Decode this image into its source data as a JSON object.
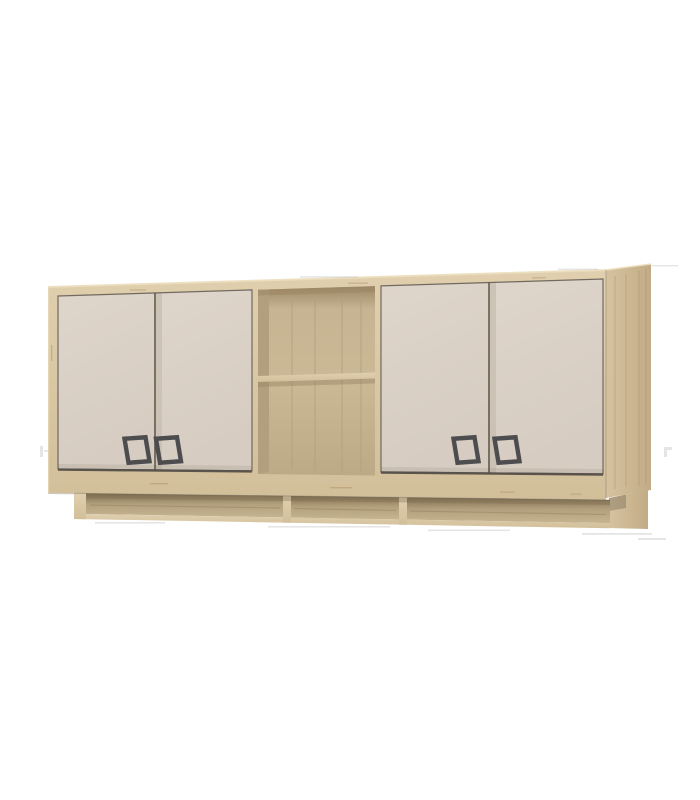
{
  "image": {
    "alt": "3D product render of a light-oak wall-mounted cabinet with four cream doors, dark square handles, a central open shelf niche with one shelf, and an open lower shelf rail with three compartments",
    "background": "#ffffff"
  },
  "structure": {
    "door_count": 4,
    "handle_count": 4,
    "open_shelf_levels": 2,
    "rail_compartments": 3
  },
  "colors": {
    "wood_light": "#e0cfae",
    "wood_mid": "#d2bf9a",
    "wood_edge_highlight": "#ecdebd",
    "wood_side": "#d6c29f",
    "wood_side_dark": "#c2ac86",
    "wood_grain": "#a98e62",
    "interior_shadow": "#9c8765",
    "interior_back": "#c6b492",
    "interior_back_light": "#cbb996",
    "interior_mid": "#bcaa86",
    "interior_wall": "#b29f7d",
    "rail_shadow": "#7e6c4f",
    "rail_mid": "#b2a07d",
    "rail_light": "#c6b491",
    "door_cream_light": "#ded5cb",
    "door_cream": "#d6ccc1",
    "door_shadow": "#c8beb2",
    "handle": "#4d4e50",
    "outline": "#55504a",
    "artifact": "#c6c6c6"
  }
}
